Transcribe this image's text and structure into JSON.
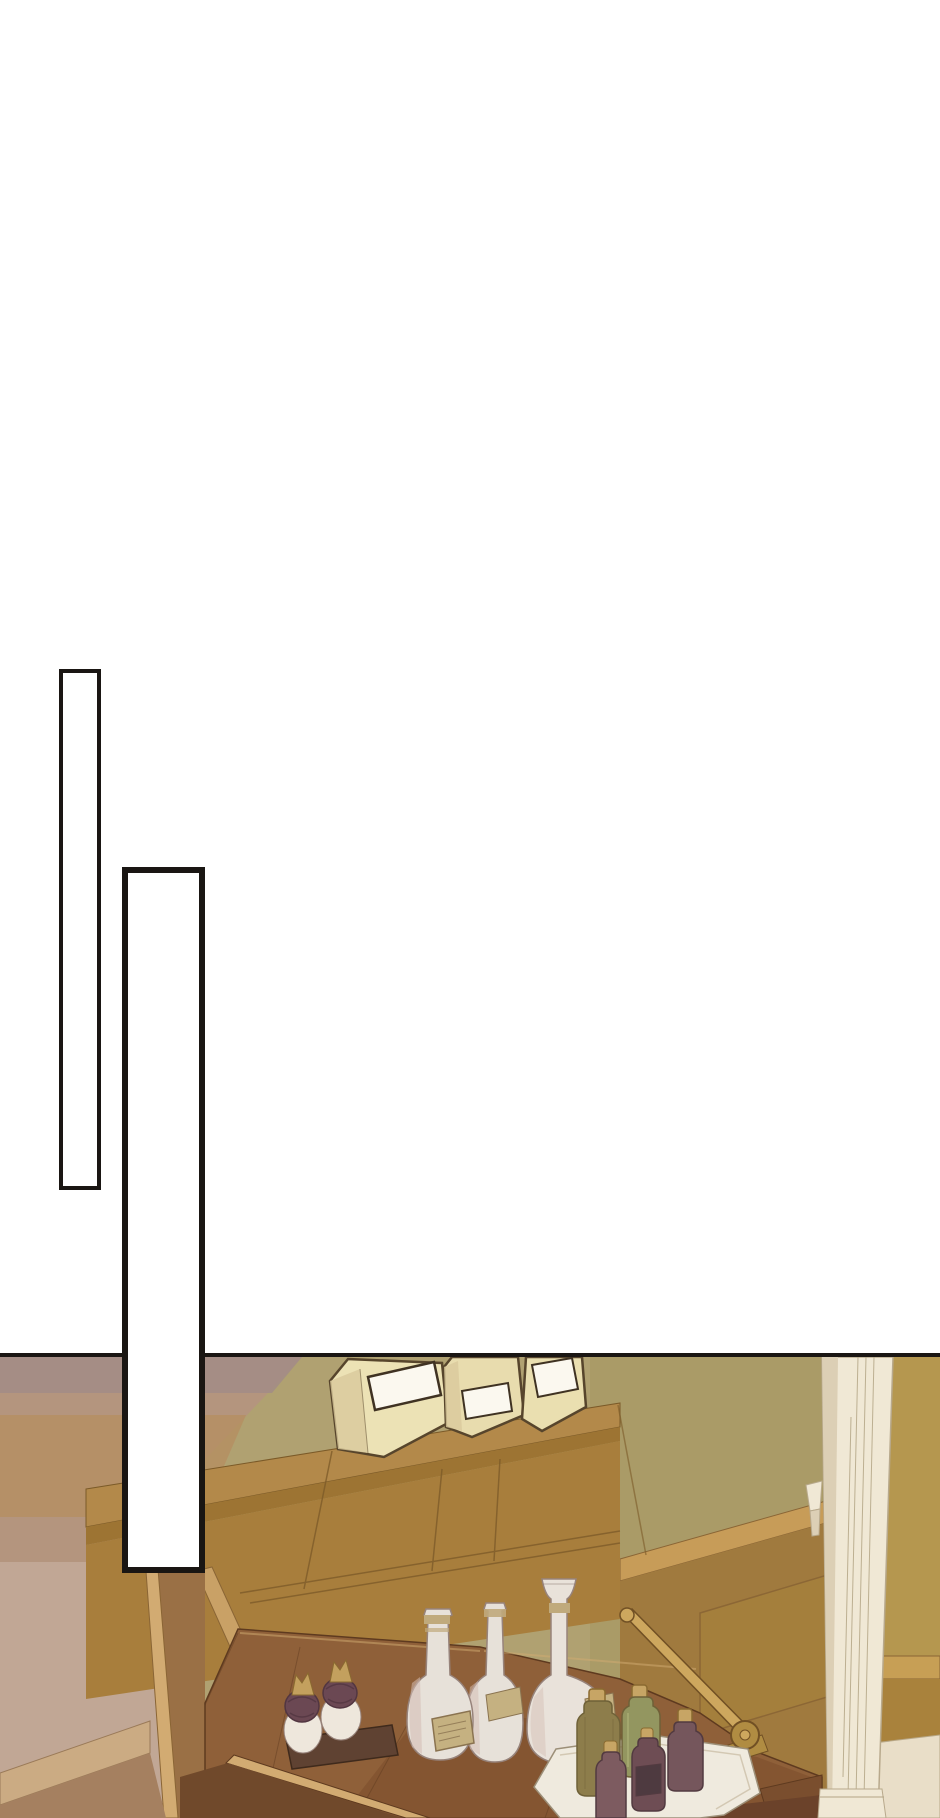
{
  "scene": {
    "type": "webtoon-comic-panel",
    "balloons": {
      "balloon_1": {
        "text": ""
      },
      "balloon_2": {
        "text": ""
      }
    },
    "objects": [
      "empty-vertical-speech-balloon",
      "empty-vertical-speech-balloon",
      "paper-bags-with-blank-labels",
      "wood-shelf-cabinet",
      "secretary-desk-open-leaf",
      "white-porcelain-bottles",
      "long-neck-decanter",
      "ornate-ink-pots-on-stand",
      "brass-stay-arm-with-hinge",
      "tray-of-small-potion-bottles",
      "white-door-pillar",
      "wood-wainscot-wall"
    ]
  },
  "palette": {
    "paper-white": "#ffffff",
    "line-black": "#1a1613",
    "wall-mauve": "#b4957e",
    "wall-mauve-top": "#a28c86",
    "wall-mauve-warm": "#b58e62",
    "wall-mauve-low": "#c3aa99",
    "wall-olive": "#b0a171",
    "wall-olive-dark": "#a5975e",
    "wall-tan-right": "#b5974f",
    "rail-wood": "#c79c58",
    "panel-wood": "#a07a3e",
    "panel-wood-line": "#8a6535",
    "panel-wood-inner": "#a5803c",
    "wainscot-right-rail": "#c79f55",
    "wainscot-right-panel": "#a9823c",
    "shelf-top": "#b3894a",
    "shelf-front": "#9d7433",
    "hutch-face": "#a87e3c",
    "hutch-line": "#7b5a28",
    "hutch-edge-light": "#c9a166",
    "desk-top": "#8f6039",
    "desk-top-dark": "#7b4d2b",
    "desk-line": "#5e3a1f",
    "desk-edge-light": "#d2ab72",
    "desk-side": "#9a7045",
    "desk-shadow": "#70492b",
    "desk-step": "#7a4e2e",
    "desk-under": "#6b422a",
    "baseboard": "#cbab83",
    "baseboard-line": "#9a7a58",
    "floor-left": "#a58060",
    "floor-right": "#e9dec8",
    "floor-right-line": "#b8a888",
    "pillar": "#f0e8d5",
    "pillar-shade": "#dccfb5",
    "pillar-line": "#b3a485",
    "pillar-outline": "#b8a98c",
    "bag-cream": "#ece2b5",
    "bag-cream-2": "#e8dcae",
    "bag-cream-3": "#eadfb0",
    "bag-shade": "#d9c99c",
    "bag-outline": "#57452c",
    "label-white": "#fbf8ef",
    "label-outline": "#3f3222",
    "bottle-white": "#e7e1d9",
    "bottle-white-shade": "#d3bcb2",
    "bottle-outline": "#97837b",
    "gold-band": "#c0aa7c",
    "label-tan": "#c5b181",
    "label-tan-line": "#8a7350",
    "decanter-white": "#e9e2da",
    "brass": "#cda75e",
    "brass-dark": "#b08c42",
    "brass-outline": "#715024",
    "pot-white": "#eee7dc",
    "pot-lid": "#6b4853",
    "pot-lid-dark": "#523641",
    "pot-gold": "#c3a05e",
    "stand-wood": "#5f4232",
    "stand-line": "#3f2a1c",
    "tray-white": "#efeade",
    "tray-line": "#9c8f78",
    "tray-inner": "#cfc4ae",
    "bottle-olive": "#8d7d4b",
    "bottle-olive-line": "#6f6138",
    "bottle-green": "#939660",
    "bottle-green-hi": "#a8ab72",
    "cork": "#c7a565",
    "cork-line": "#8a6a30",
    "bottle-plum": "#7d5b60",
    "bottle-plum-2": "#6e4d54",
    "bottle-plum-3": "#75565c",
    "bottle-plum-line": "#523a40",
    "plum-label": "#4e3a40"
  }
}
